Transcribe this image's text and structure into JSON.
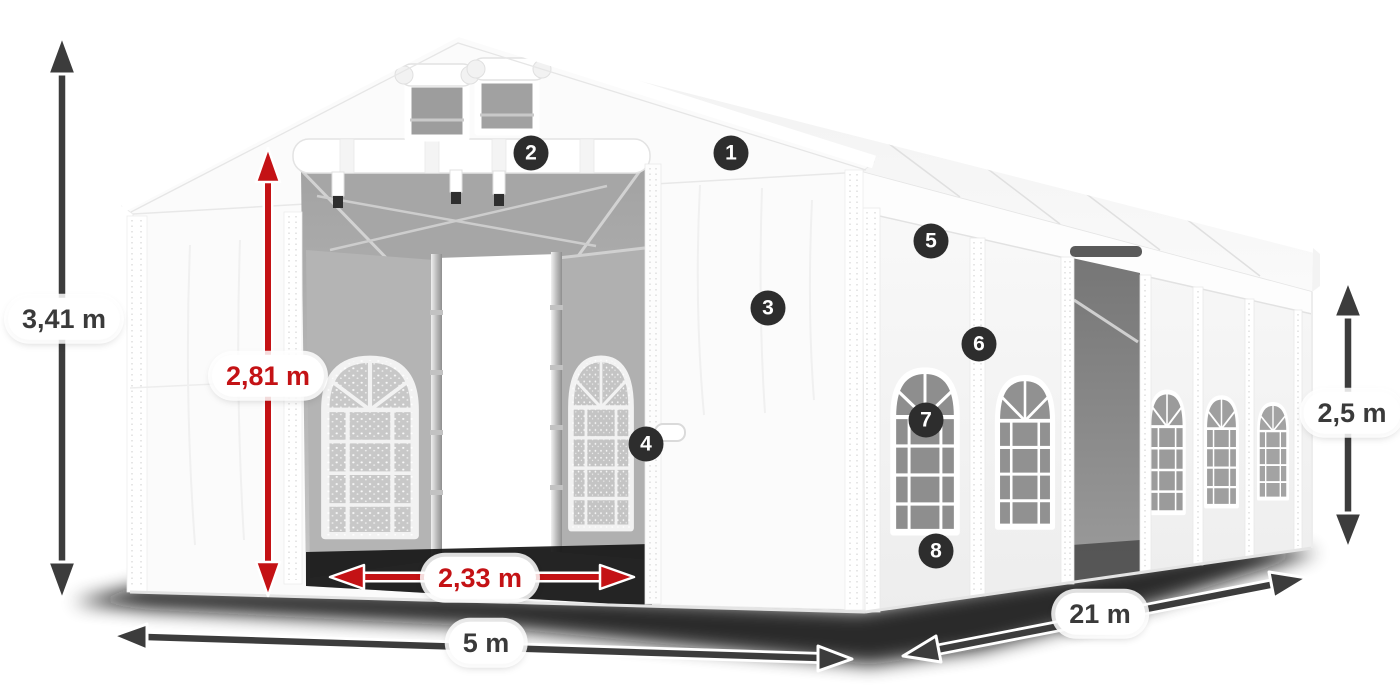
{
  "colors": {
    "red_accent": "#c41215",
    "dark_accent": "#3c3c3c",
    "marker_background": "#2d2d2d",
    "marker_text": "#ffffff",
    "tent_white": "#fbfbfb"
  },
  "dimensions": {
    "total_height": {
      "label": "3,41 m",
      "style": "dark"
    },
    "entrance_height": {
      "label": "2,81 m",
      "style": "red"
    },
    "entrance_width": {
      "label": "2,33 m",
      "style": "red"
    },
    "front_width": {
      "label": "5 m",
      "style": "dark"
    },
    "side_length": {
      "label": "21 m",
      "style": "dark"
    },
    "side_wall_height": {
      "label": "2,5 m",
      "style": "dark"
    }
  },
  "markers": [
    {
      "number": "1"
    },
    {
      "number": "2"
    },
    {
      "number": "3"
    },
    {
      "number": "4"
    },
    {
      "number": "5"
    },
    {
      "number": "6"
    },
    {
      "number": "7"
    },
    {
      "number": "8"
    }
  ]
}
